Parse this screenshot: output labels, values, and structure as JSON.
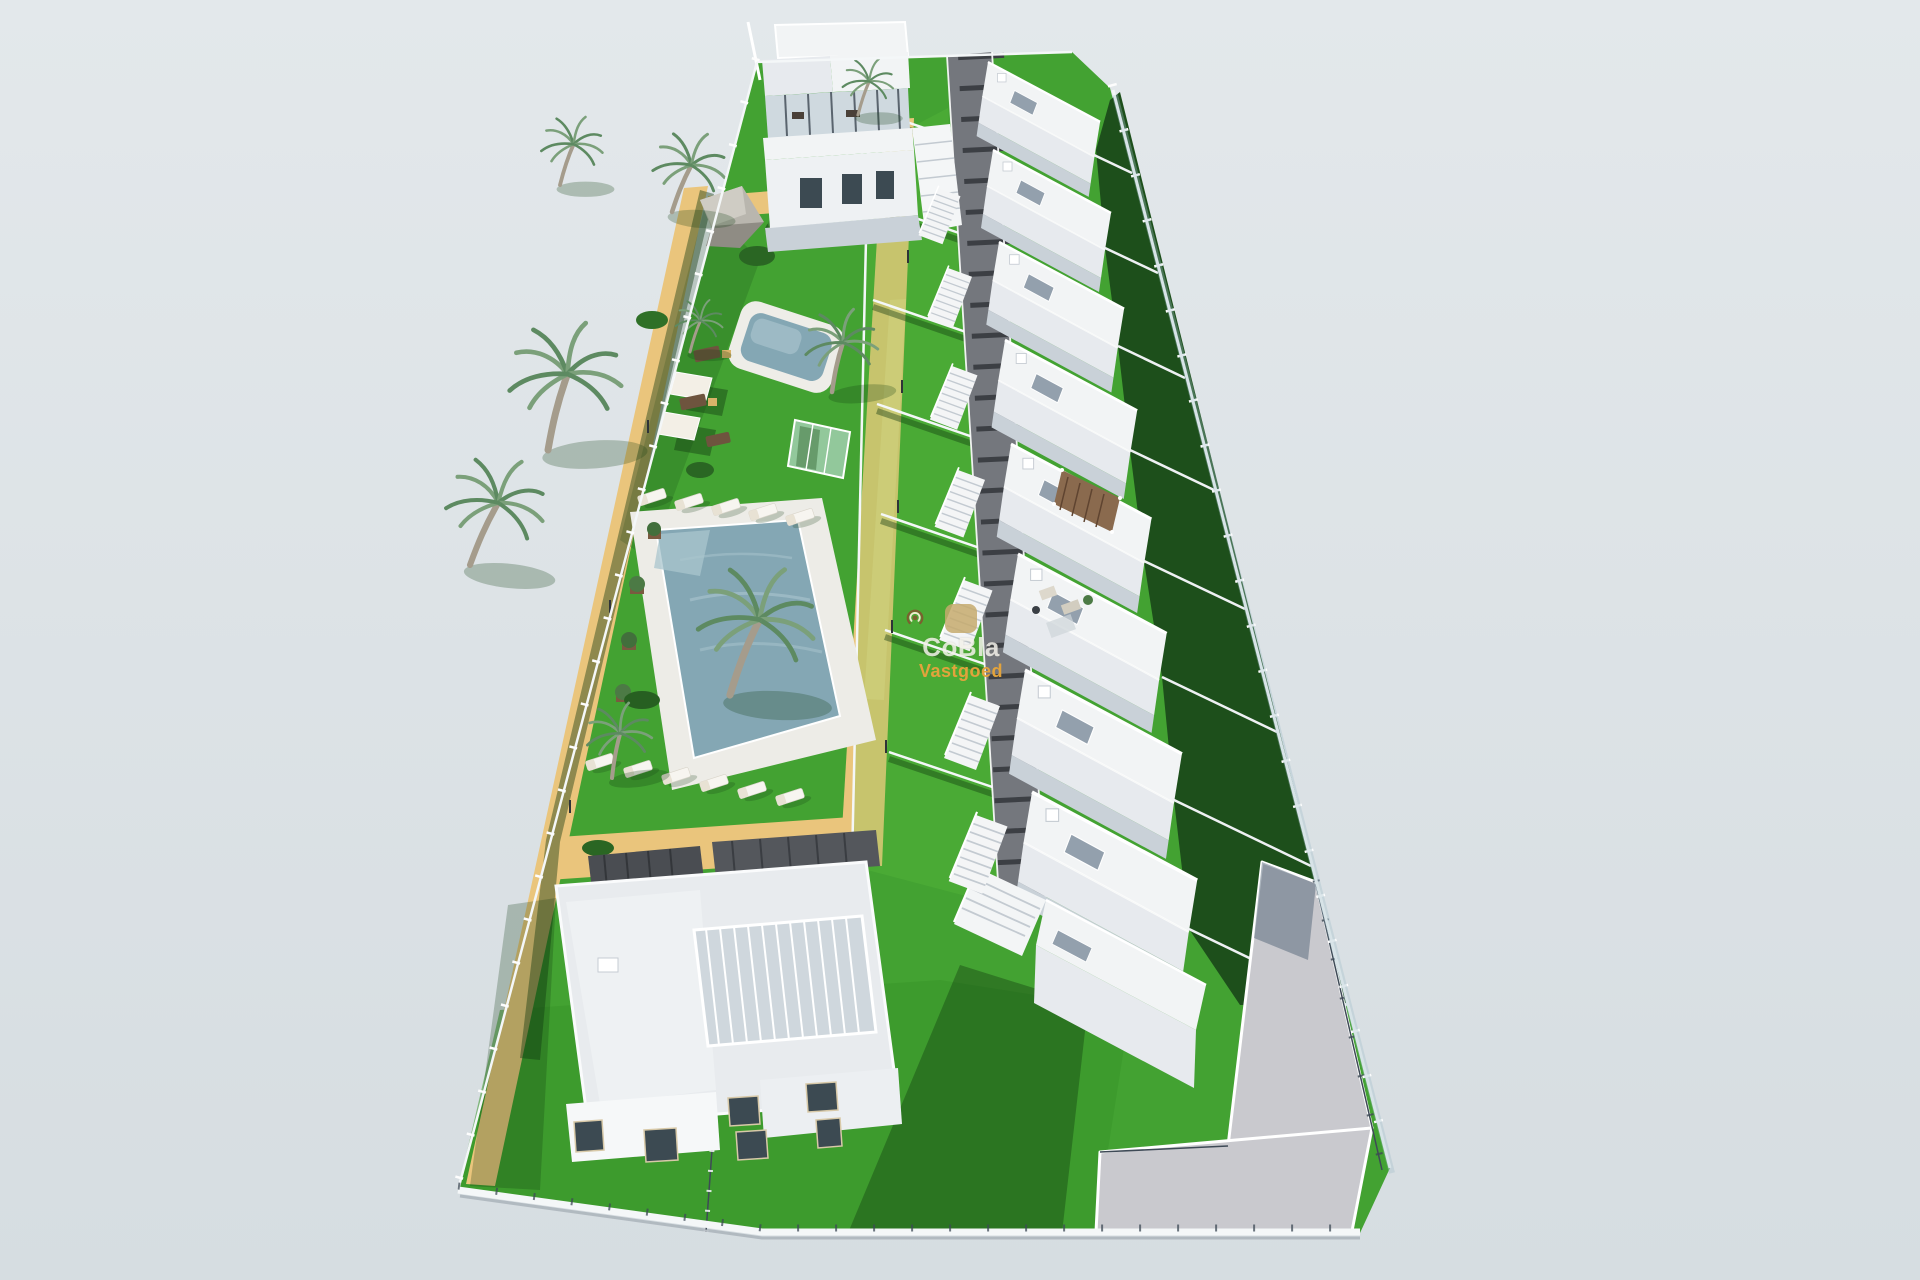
{
  "scene": {
    "type": "3d-architectural-render",
    "view": "aerial-perspective",
    "subject": "new-build residential development: row of white townhouses with roof terraces, communal garden with two swimming pools, sun loungers, palm trees and two detached villas inside a fenced plot"
  },
  "watermark": {
    "brand": "CoBla",
    "subtitle": "Vastgoed"
  },
  "palette": {
    "sky_top": "#e3e8eb",
    "sky_bottom": "#d6dde1",
    "lawn": "#43a232",
    "lawn_deep": "#38962a",
    "garden_dark": "#1d4f1b",
    "sand": "#eac57c",
    "sand_light": "#f3d694",
    "water": "#84a7b4",
    "water_light": "#aac5ce",
    "white_roof": "#f2f4f5",
    "white_wall": "#fafbfc",
    "white_shade": "#e7eaee",
    "wall_gray": "#c9d1d8",
    "walkway": "#74777d",
    "beam": "#3c3f44",
    "driveway": "#c9c9ce",
    "window_dark": "#3c4a52",
    "glass": "#9db7c2",
    "trunk": "#a59c8c",
    "frond": "#7ba07a",
    "frond_dark": "#5d8a61",
    "wood": "#8a6a4e",
    "shadow_green": "rgba(14,54,14,0.42)",
    "fence": "#f4f7f8",
    "logo_bg": "rgba(197,170,109,0.85)",
    "logo_arc": "#7c5f2f",
    "logo_arc_light": "#f3ead2",
    "brand_color": "rgba(248,246,240,0.82)",
    "subtitle_color": "#e2a33c"
  }
}
